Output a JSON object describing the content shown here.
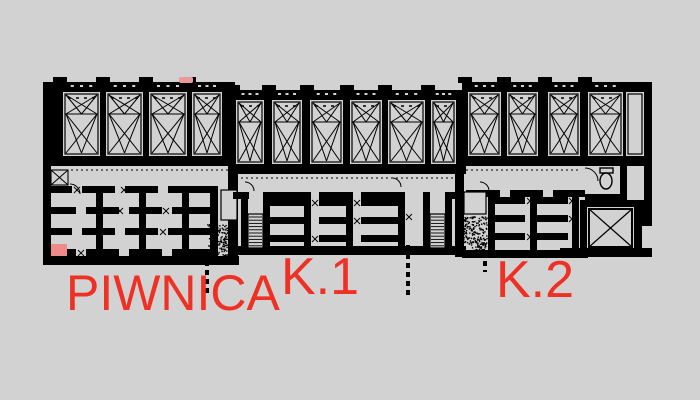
{
  "drawing": {
    "kind": "basement-floor-plan",
    "labels": {
      "floor": {
        "text": "PIWNICA"
      },
      "stair1": {
        "text": "K.1"
      },
      "stair2": {
        "text": "K.2"
      }
    },
    "colors": {
      "background": "#d2d2d2",
      "ink": "#000000",
      "label_red": "#ee3124",
      "highlight_cell": "#f08a8a",
      "wall_smudge": "#e89a9a"
    },
    "counts": {
      "top_rooms": 14,
      "stairs": 2,
      "stipple_regions": 2
    }
  }
}
